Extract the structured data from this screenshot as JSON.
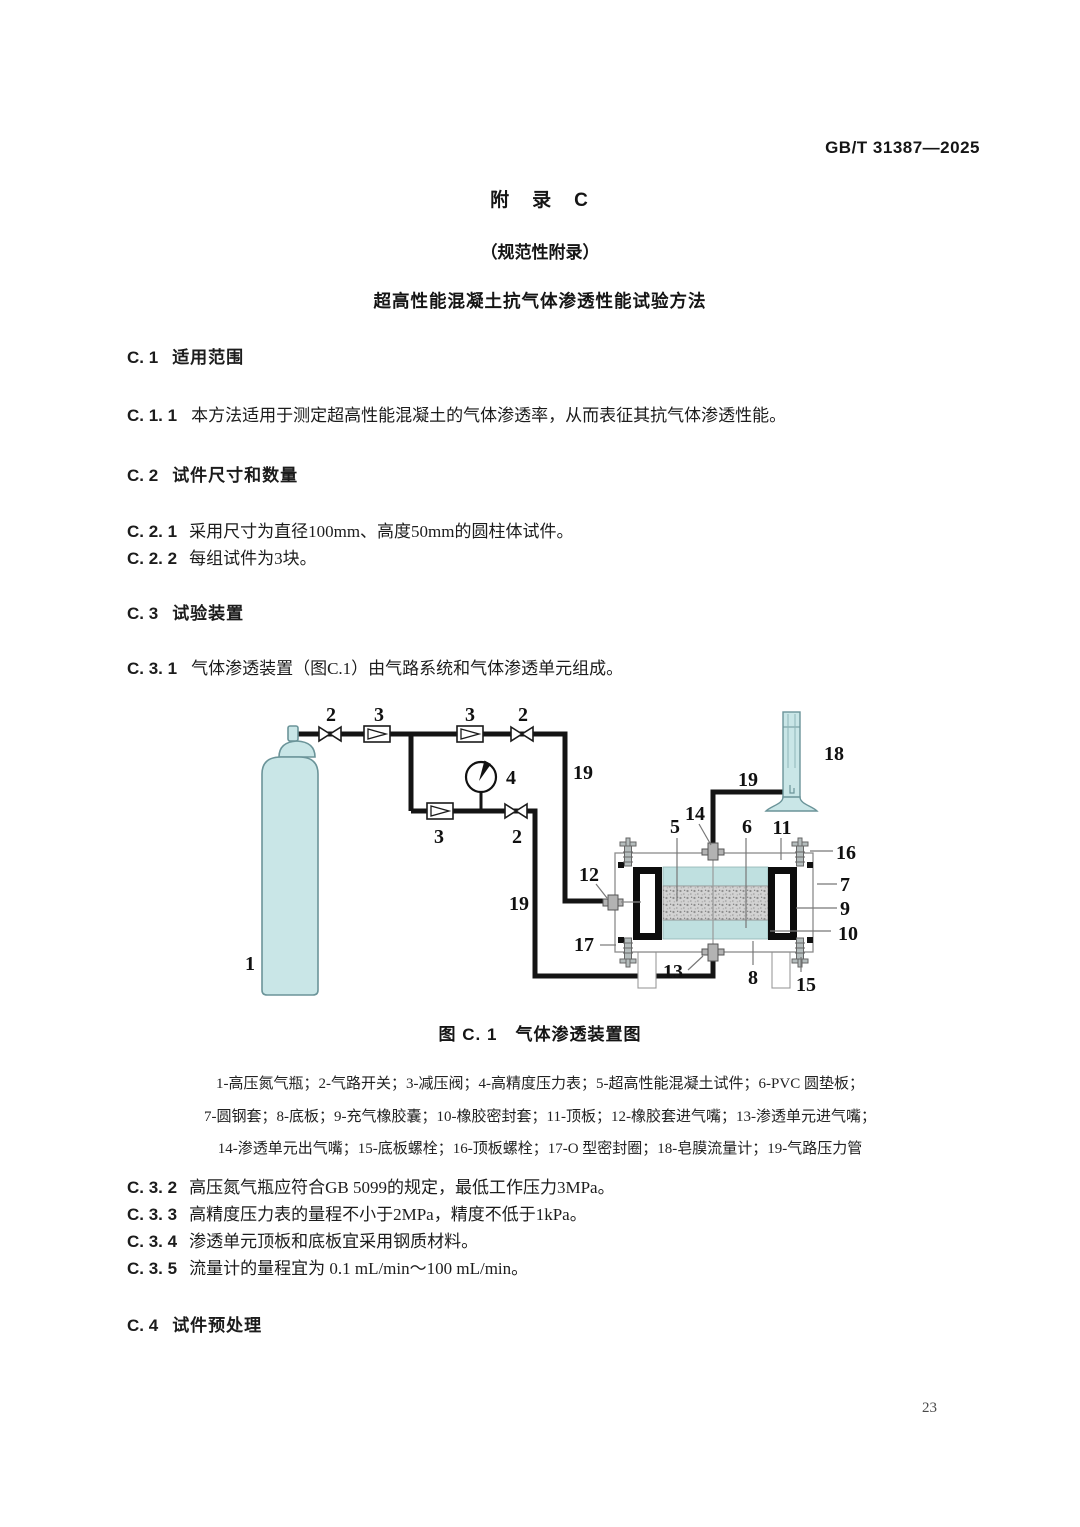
{
  "doc": {
    "standard_code": "GB/T 31387—2025",
    "page_number": "23"
  },
  "titles": {
    "appendix_label": "附　录　C",
    "appendix_type": "（规范性附录）",
    "method_title": "超高性能混凝土抗气体渗透性能试验方法"
  },
  "clauses": {
    "c1": {
      "num": "C. 1",
      "title": "适用范围"
    },
    "c1_1": {
      "num": "C. 1. 1",
      "text": "本方法适用于测定超高性能混凝土的气体渗透率，从而表征其抗气体渗透性能。"
    },
    "c2": {
      "num": "C. 2",
      "title": "试件尺寸和数量"
    },
    "c2_1": {
      "num": "C. 2. 1",
      "text": "采用尺寸为直径100mm、高度50mm的圆柱体试件。"
    },
    "c2_2": {
      "num": "C. 2. 2",
      "text": "每组试件为3块。"
    },
    "c3": {
      "num": "C. 3",
      "title": "试验装置"
    },
    "c3_1": {
      "num": "C. 3. 1",
      "text": "气体渗透装置（图C.1）由气路系统和气体渗透单元组成。"
    },
    "c3_2": {
      "num": "C. 3. 2",
      "text": "高压氮气瓶应符合GB 5099的规定，最低工作压力3MPa。"
    },
    "c3_3": {
      "num": "C. 3. 3",
      "text": "高精度压力表的量程不小于2MPa，精度不低于1kPa。"
    },
    "c3_4": {
      "num": "C. 3. 4",
      "text": "渗透单元顶板和底板宜采用钢质材料。"
    },
    "c3_5": {
      "num": "C. 3. 5",
      "text": "流量计的量程宜为 0.1 mL/min～100 mL/min。"
    },
    "c4": {
      "num": "C. 4",
      "title": "试件预处理"
    }
  },
  "figure": {
    "caption": "图 C. 1　气体渗透装置图",
    "legend_lines": [
      "1-高压氮气瓶；2-气路开关；3-减压阀；4-高精度压力表；5-超高性能混凝土试件；6-PVC 圆垫板；",
      "7-圆钢套；8-底板；9-充气橡胶囊；10-橡胶密封套；11-顶板；12-橡胶套进气嘴；13-渗透单元进气嘴；",
      "14-渗透单元出气嘴；15-底板螺栓；16-顶板螺栓；17-O 型密封圈；18-皂膜流量计；19-气路压力管"
    ],
    "labels": {
      "l1": "1",
      "l2a": "2",
      "l3a": "3",
      "l3b": "3",
      "l2b": "2",
      "l4": "4",
      "l3c": "3",
      "l2c": "2",
      "l19a": "19",
      "l19b": "19",
      "l19c": "19",
      "l5": "5",
      "l6": "6",
      "l7": "7",
      "l8": "8",
      "l9": "9",
      "l10": "10",
      "l11": "11",
      "l12": "12",
      "l13": "13",
      "l14": "14",
      "l15": "15",
      "l16": "16",
      "l17": "17",
      "l18": "18"
    },
    "colors": {
      "equipment_fill": "#c9e6e7",
      "equipment_outline": "#6b9499",
      "pipe": "#141414",
      "cell_pad_fill": "#bfe0e0",
      "specimen_gray": "#d2d2d2"
    }
  }
}
